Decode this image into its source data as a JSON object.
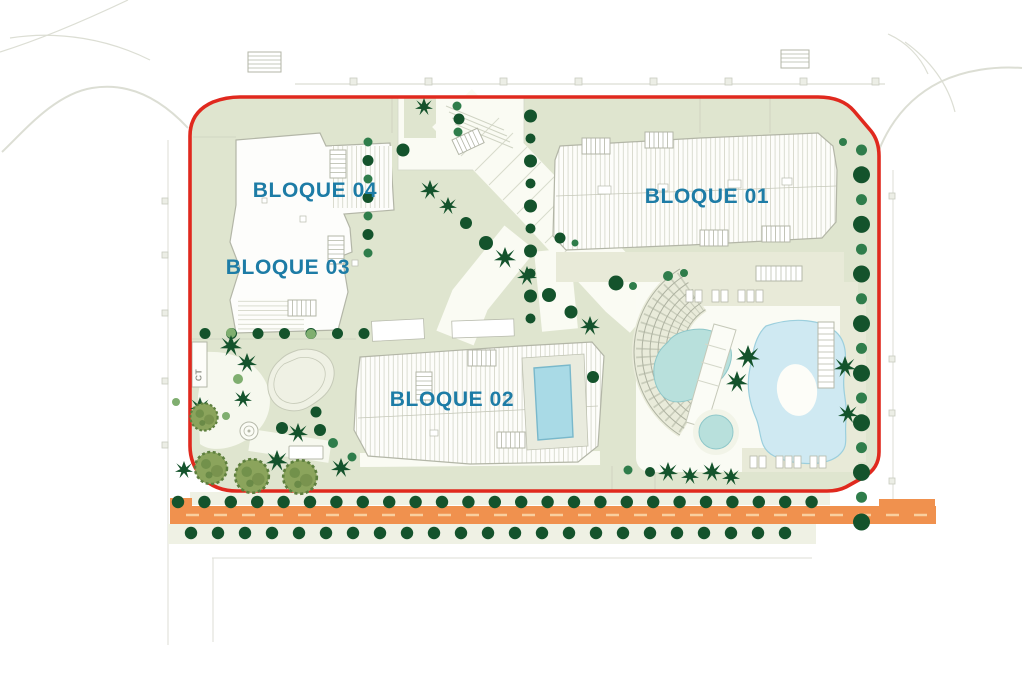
{
  "plan": {
    "type": "residential-site-plan",
    "labels": {
      "bloque01": "BLOQUE 01",
      "bloque02": "BLOQUE 02",
      "bloque03": "BLOQUE 03",
      "bloque04": "BLOQUE 04",
      "ct": "CT"
    }
  },
  "colors": {
    "boundary_red": "#e0291e",
    "label_blue": "#1d7ca6",
    "road_orange": "#f0914e",
    "road_dash": "#f9cf9f",
    "site_green": "#dfe5cf",
    "deck_beige": "#e8ead8",
    "path_white": "#fafbf3",
    "pool_lagoon_blue": "#cfe9f2",
    "pool_kidney_teal": "#b8e0dc",
    "pool_rooftop": "#a9dae6",
    "tree_dark": "#14532c",
    "tree_mid": "#2f7d4b",
    "tree_light": "#7fae6f",
    "canopy_olive": "#8ba45c",
    "building_line": "#b3b6a7",
    "faint_road_gray": "#dcded4"
  },
  "vegetation": {
    "lines": [
      {
        "x": 178,
        "y": 502,
        "dx": 26.4,
        "dy": 0,
        "n": 25,
        "r": [
          6.2
        ],
        "c": [
          "dark"
        ]
      },
      {
        "x": 191,
        "y": 533,
        "dx": 27,
        "dy": 0,
        "n": 23,
        "r": [
          6.2
        ],
        "c": [
          "dark"
        ]
      },
      {
        "x": 205,
        "y": 333.5,
        "dx": 26.5,
        "dy": 0,
        "n": 7,
        "r": [
          5.5
        ],
        "c": [
          "dark"
        ]
      },
      {
        "x": 530.5,
        "y": 116,
        "dx": 0,
        "dy": 22.5,
        "n": 10,
        "r": [
          6.5,
          5
        ],
        "c": [
          "dark"
        ]
      },
      {
        "x": 861.5,
        "y": 150,
        "dx": 0,
        "dy": 24.8,
        "n": 16,
        "r": [
          5.5,
          8.5
        ],
        "c": [
          "mid",
          "dark"
        ]
      },
      {
        "x": 368,
        "y": 142,
        "dx": 0,
        "dy": 18.5,
        "n": 7,
        "r": [
          4.5,
          5.5
        ],
        "c": [
          "mid",
          "dark"
        ]
      }
    ],
    "trees": [
      [
        403,
        150,
        6.5,
        "dark"
      ],
      [
        457,
        106,
        4.5,
        "mid"
      ],
      [
        459,
        119,
        5.5,
        "dark"
      ],
      [
        458,
        132,
        4.5,
        "mid"
      ],
      [
        560,
        238,
        5.5,
        "dark"
      ],
      [
        575,
        243,
        3.5,
        "mid"
      ],
      [
        466,
        223,
        6,
        "dark"
      ],
      [
        486,
        243,
        7,
        "dark"
      ],
      [
        549,
        295,
        7,
        "dark"
      ],
      [
        571,
        312,
        6.5,
        "dark"
      ],
      [
        616,
        283,
        7.5,
        "dark"
      ],
      [
        633,
        286,
        4,
        "mid"
      ],
      [
        668,
        276,
        5,
        "mid"
      ],
      [
        684,
        273,
        4,
        "mid"
      ],
      [
        593,
        377,
        6,
        "dark"
      ],
      [
        238,
        379,
        5,
        "light"
      ],
      [
        282,
        428,
        6,
        "dark"
      ],
      [
        316,
        412,
        5.5,
        "dark"
      ],
      [
        320,
        430,
        6,
        "dark"
      ],
      [
        333,
        443,
        5,
        "mid"
      ],
      [
        352,
        457,
        4.5,
        "mid"
      ],
      [
        231,
        333,
        5,
        "light"
      ],
      [
        311,
        334,
        5,
        "light"
      ],
      [
        176,
        402,
        4,
        "light"
      ],
      [
        226,
        416,
        4,
        "light"
      ],
      [
        843,
        142,
        4,
        "mid"
      ],
      [
        650,
        472,
        5,
        "dark"
      ],
      [
        628,
        470,
        4.5,
        "mid"
      ]
    ],
    "palms": [
      [
        424,
        107,
        0.9
      ],
      [
        430,
        190,
        1.0
      ],
      [
        448,
        206,
        0.9
      ],
      [
        505,
        258,
        1.1
      ],
      [
        527,
        276,
        1.0
      ],
      [
        590,
        326,
        1.0
      ],
      [
        748,
        357,
        1.2
      ],
      [
        737,
        382,
        1.1
      ],
      [
        845,
        367,
        1.1
      ],
      [
        848,
        414,
        1.0
      ],
      [
        668,
        472,
        1.0
      ],
      [
        690,
        476,
        0.9
      ],
      [
        712,
        472,
        1.0
      ],
      [
        731,
        477,
        0.9
      ],
      [
        231,
        346,
        1.1
      ],
      [
        247,
        363,
        1.0
      ],
      [
        243,
        399,
        0.9
      ],
      [
        200,
        407,
        1.0
      ],
      [
        277,
        461,
        1.1
      ],
      [
        341,
        468,
        1.0
      ],
      [
        298,
        433,
        1.0
      ],
      [
        184,
        470,
        0.9
      ]
    ],
    "canopies": [
      [
        204,
        417,
        0.85
      ],
      [
        211,
        468,
        1.0
      ],
      [
        252,
        476,
        1.05
      ],
      [
        300,
        477,
        1.05
      ]
    ]
  }
}
